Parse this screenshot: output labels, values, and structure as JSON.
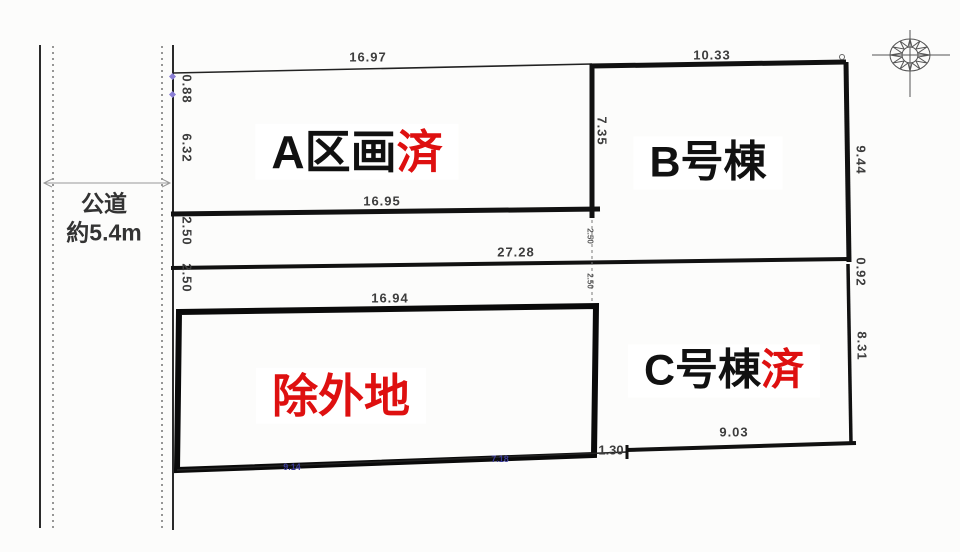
{
  "road": {
    "name": "公道",
    "width": "約5.4m"
  },
  "plots": {
    "a": {
      "name": "A区画",
      "status": "済"
    },
    "b": {
      "name": "B号棟"
    },
    "c": {
      "name": "C号棟",
      "status": "済"
    },
    "excluded": {
      "name": "除外地"
    }
  },
  "dimensions": {
    "a_top": "16.97",
    "a_bottom": "16.95",
    "a_left_upper": "0.88",
    "a_left_lower": "6.32",
    "b_top": "10.33",
    "b_left": "7.35",
    "b_right": "9.44",
    "strip1_left": "2.50",
    "strip2_left": "2.50",
    "strip1_mid": "2.50",
    "strip2_mid": "2.50",
    "mid_width": "27.28",
    "excluded_top": "16.94",
    "excluded_bottom_left": "9.14",
    "excluded_bottom_right": "7.18",
    "c_right_offset": "0.92",
    "c_right": "8.31",
    "c_bottom": "9.03",
    "c_bottom_left": "1.30"
  },
  "colors": {
    "accent_red": "#de1010",
    "line_black": "#141414",
    "dim_text": "#3d3d3d",
    "blue_text": "#3a3a96"
  }
}
